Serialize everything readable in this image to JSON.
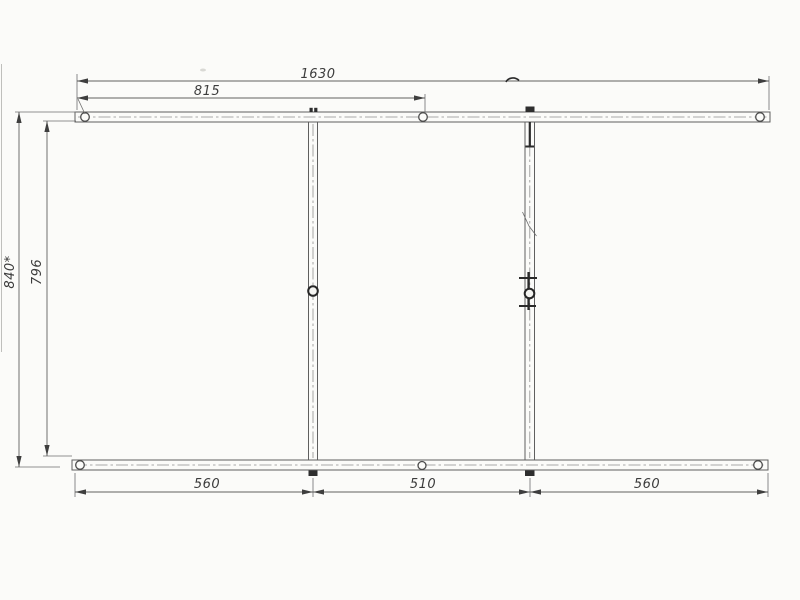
{
  "dims": {
    "top_overall": "1630",
    "top_half": "815",
    "left_overall": "840*",
    "left_inner": "796",
    "bottom_left": "560",
    "bottom_center": "510",
    "bottom_right": "560"
  },
  "colors": {
    "paper": "#fbfbf9",
    "line": "#5f5f5f",
    "centerline": "#8f8f8f",
    "dim_text": "#3c3c3c",
    "dark_feature": "#2e2e2e"
  }
}
